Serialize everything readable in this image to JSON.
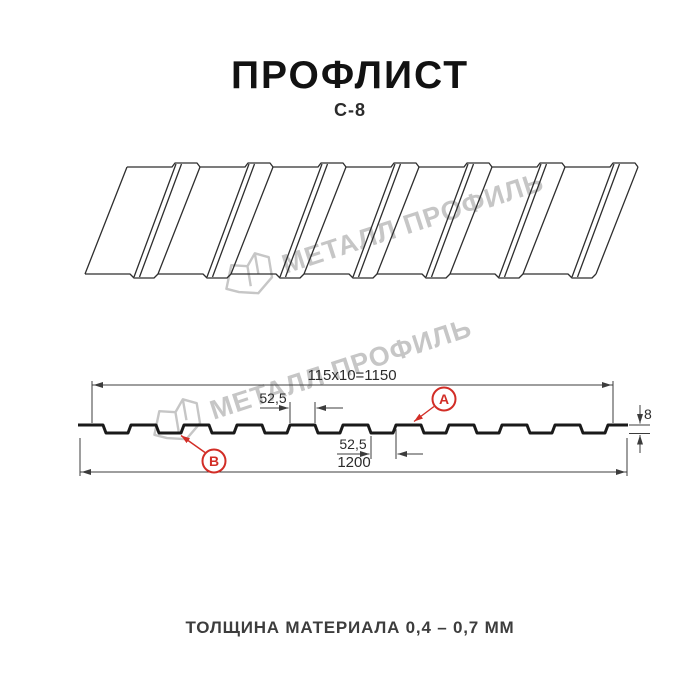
{
  "header": {
    "title": "ПРОФЛИСТ",
    "model": "С-8"
  },
  "watermark": {
    "brand": "МЕТАЛЛ ПРОФИЛЬ"
  },
  "cross_section": {
    "dim_module_width": "115x10=1150",
    "dim_rib_top": "52,5",
    "dim_rib_bottom": "52,5",
    "dim_profile_height": "8",
    "dim_overall_width": "1200",
    "marker_a": "А",
    "marker_b": "В"
  },
  "footer": {
    "thickness_note": "ТОЛЩИНА МАТЕРИАЛА 0,4 – 0,7 ММ"
  },
  "colors": {
    "accent_red": "#d22d26",
    "profile_line": "#1a1a1a",
    "dim_line": "#3c3c3c",
    "watermark_gray": "#c6c6c6"
  }
}
